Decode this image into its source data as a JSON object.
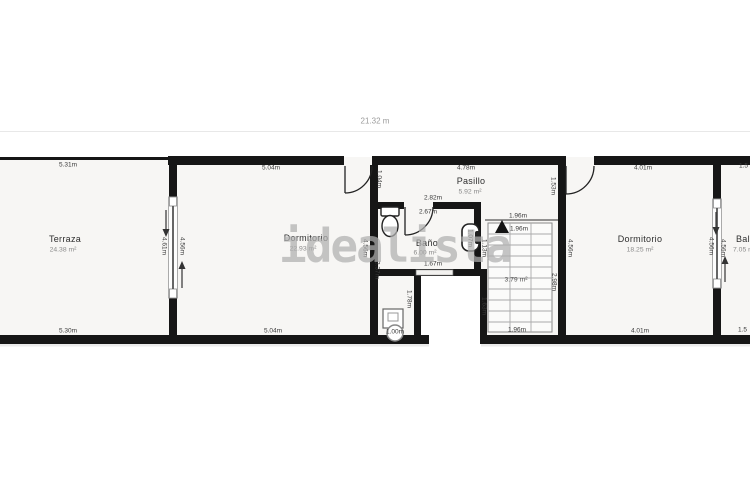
{
  "meta": {
    "overall_width": "21.32 m",
    "watermark": "idealista"
  },
  "rooms": {
    "terraza": {
      "name": "Terraza",
      "area": "24.38 m²"
    },
    "dormitorio1": {
      "name": "Dormitorio",
      "area": "22.93 m²"
    },
    "pasillo": {
      "name": "Pasillo",
      "area": "5.92 m²"
    },
    "bano": {
      "name": "Baño",
      "area": "6.00 m²"
    },
    "escalera": {
      "area": "3.79 m²"
    },
    "dormitorio2": {
      "name": "Dormitorio",
      "area": "18.25 m²"
    },
    "balcon": {
      "name": "Balcón",
      "area": "7.05 m²"
    }
  },
  "dims": {
    "terraza_top": "5.31m",
    "terraza_bottom": "5.30m",
    "divider1_terraza_side": "4.61m",
    "divider1_dorm_side": "4.56m",
    "dorm1_top": "5.04m",
    "dorm1_bottom": "5.04m",
    "dorm1_right": "4.56m",
    "dorm1_door": "1.04m",
    "pasillo_top": "4.78m",
    "bano_top_outer": "2.82m",
    "bano_top_inner": "2.67m",
    "bano_bottom": "1.67m",
    "bano_left": "3.37m",
    "bano_sink": "1.07m",
    "laundry_right": "1.78m",
    "laundry_bottom": "1.00m",
    "stairs_top_outer": "1.96m",
    "stairs_top_inner": "1.96m",
    "stairs_bottom": "1.96m",
    "stairs_left_upper": "1.13m",
    "stairs_left_lower": "1.63m",
    "stairs_right": "2.98m",
    "dorm2_door_jamb": "1.53m",
    "dorm2_top": "4.01m",
    "dorm2_bottom": "4.01m",
    "dorm2_left": "4.56m",
    "divider2_dorm_side": "4.56m",
    "divider2_balcon_side": "4.56m",
    "balcon_top": "1.5",
    "balcon_bottom": "1.5"
  }
}
